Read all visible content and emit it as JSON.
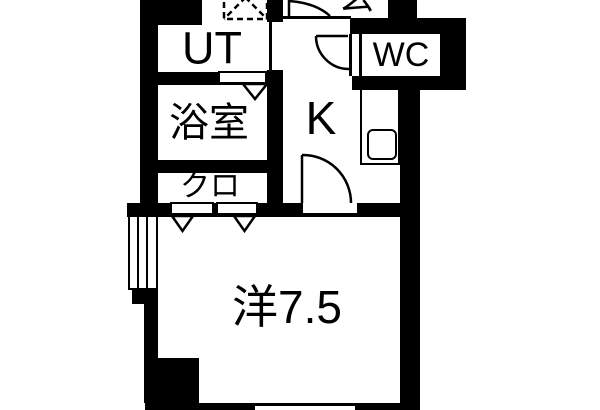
{
  "floorplan": {
    "rooms": {
      "utility": {
        "label": "UT"
      },
      "bathroom": {
        "label": "浴室"
      },
      "closet": {
        "label": "クロ"
      },
      "kitchen": {
        "label": "K"
      },
      "toilet": {
        "label": "WC"
      },
      "western_room": {
        "label": "洋7.5"
      },
      "entrance": {
        "label": "玄"
      }
    },
    "colors": {
      "wall": "#000000",
      "floor": "#ffffff",
      "text": "#000000"
    }
  }
}
